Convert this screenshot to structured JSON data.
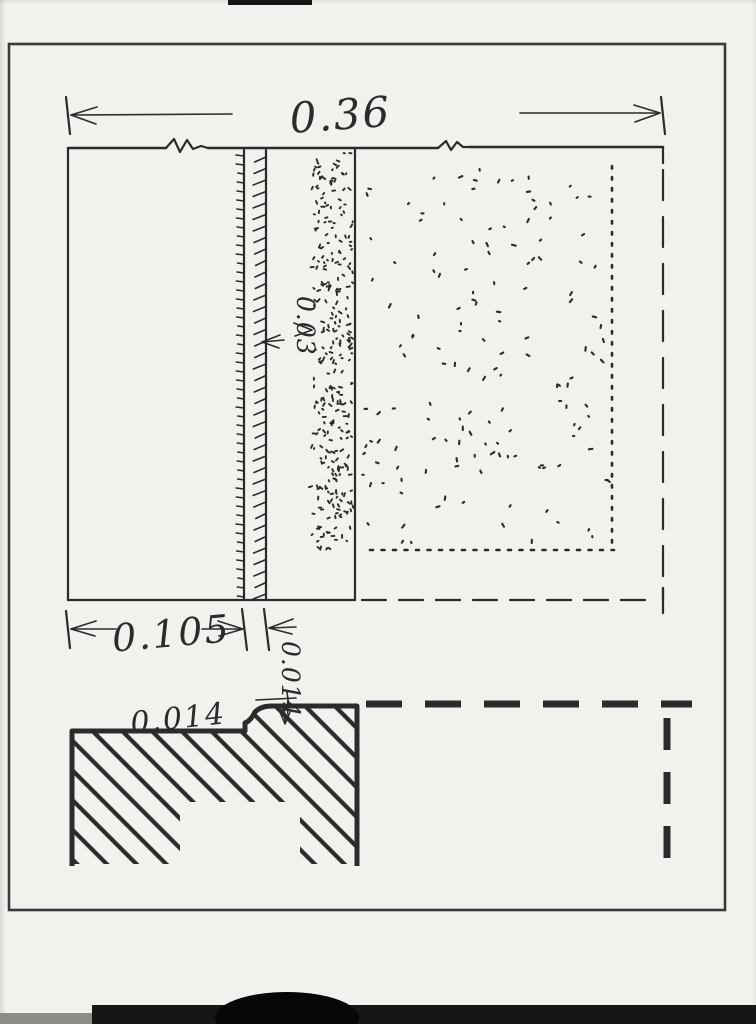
{
  "colors": {
    "ink": "#2b2b2b",
    "paper": "#f2f1ee",
    "frame": "#3a3a3a",
    "scan_band": "#161616"
  },
  "plan_view": {
    "dim_total_width": "0.36",
    "dim_left_offset": "0.105",
    "dim_board_thickness": "0.014",
    "dim_gap": "0.03"
  },
  "detail_view": {
    "dim_step_height": "0.014"
  }
}
